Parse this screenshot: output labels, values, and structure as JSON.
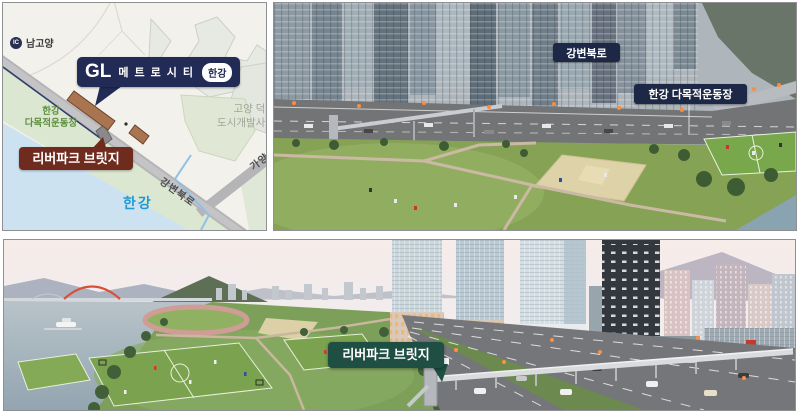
{
  "colors": {
    "callout_navy": "#222b55",
    "photo_tag_navy": "#1d2746",
    "bridge_maroon": "#6f2b1e",
    "bridge_teal": "#1e4f42",
    "map_river_text_blue": "#1e9ad6",
    "map_field_text_green": "#5f8f3f",
    "site_parcel_brown": "#a97450"
  },
  "map": {
    "interchange": {
      "icon": "IC",
      "label": "남고양"
    },
    "site_callout": {
      "logo": "GL",
      "name": "메트로시티",
      "badge": "한강"
    },
    "sports_field": {
      "line1": "한강",
      "line2": "다목적운동장"
    },
    "bridge_callout": "리버파크 브릿지",
    "river": "한강",
    "development": {
      "line1": "고양 덕은",
      "line2": "도시개발사업"
    },
    "road_main": "강변북로",
    "road_branch": "가양"
  },
  "aerial": {
    "road_label": "강변북로",
    "field_label": "한강 다목적운동장"
  },
  "render": {
    "bridge_label": "리버파크 브릿지"
  }
}
